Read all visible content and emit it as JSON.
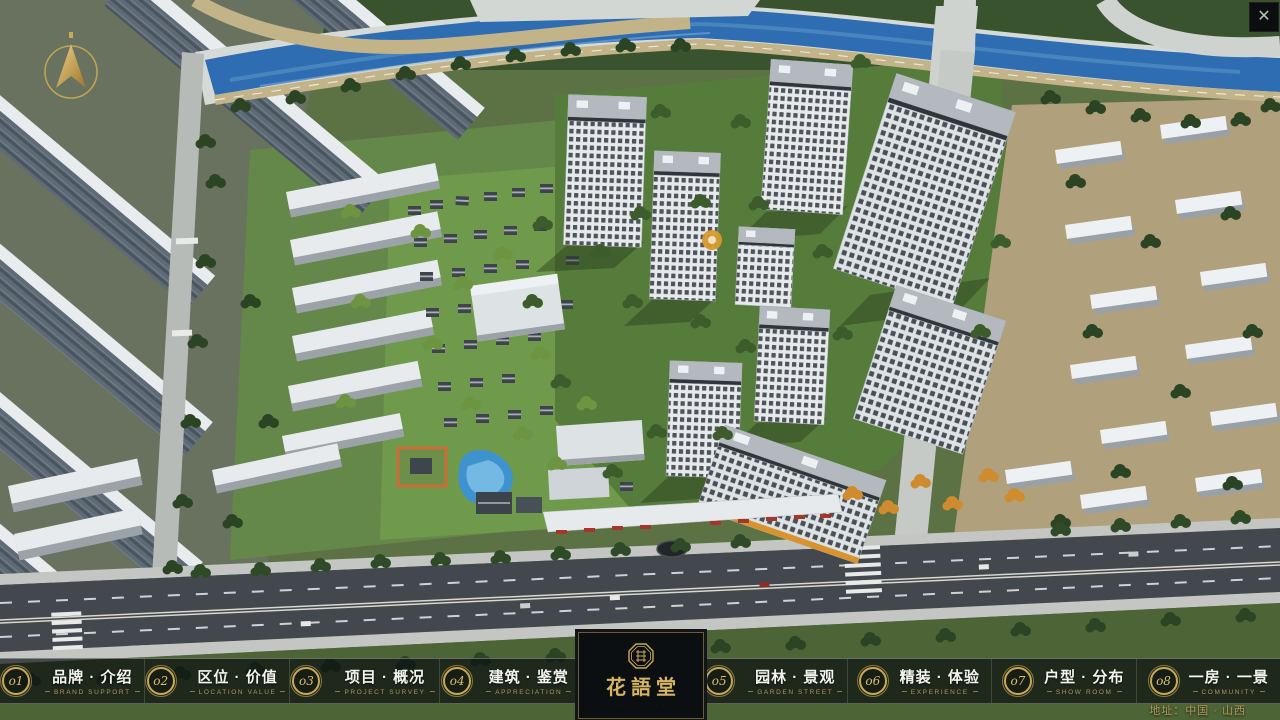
{
  "ui": {
    "close_icon": "✕",
    "address": "地址：中国 · 山西"
  },
  "logo": {
    "title": "花語堂",
    "subtitle": "· · · · · · · · · · · ·"
  },
  "nav": {
    "items": [
      {
        "num": "o1",
        "label": "品牌 · 介绍",
        "sub": "BRAND SUPPORT"
      },
      {
        "num": "o2",
        "label": "区位 · 价值",
        "sub": "LOCATION VALUE"
      },
      {
        "num": "o3",
        "label": "项目 · 概况",
        "sub": "PROJECT SURVEY"
      },
      {
        "num": "o4",
        "label": "建筑 · 鉴赏",
        "sub": "APPRECIATION"
      },
      {
        "num": "o5",
        "label": "园林 · 景观",
        "sub": "GARDEN STREET"
      },
      {
        "num": "o6",
        "label": "精装 · 体验",
        "sub": "EXPERIENCE"
      },
      {
        "num": "o7",
        "label": "户型 · 分布",
        "sub": "SHOW ROOM"
      },
      {
        "num": "o8",
        "label": "一房 · 一景",
        "sub": "COMMUNITY"
      }
    ]
  },
  "colors": {
    "accent_gold": "#c9a855",
    "gold_dim": "#b2945a",
    "bar_background": "rgba(9,13,16,0.68)",
    "river_blue": "#2f6db2",
    "pool_blue": "#3e93cf"
  }
}
